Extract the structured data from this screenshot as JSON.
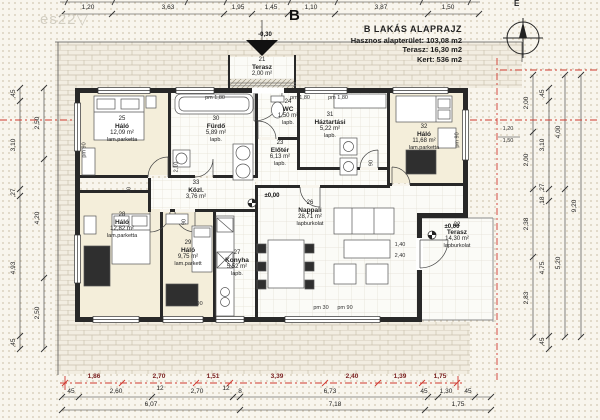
{
  "title_block": {
    "title": "B LAKÁS ALAPRAJZ",
    "line1": "Hasznos alapterület: 103,08 m2",
    "line2": "Terasz: 16,30 m2",
    "line3": "Kert: 536 m2"
  },
  "watermark": "es22▽",
  "section_marker": "B",
  "north_label": "É",
  "rooms": {
    "r21": {
      "num": "21",
      "name": "Terasz",
      "area": "2,00 m²",
      "floor": "lapburkolat"
    },
    "r22": {
      "num": "22",
      "name": "Terasz",
      "area": "14,30 m²",
      "floor": "lapburkolat"
    },
    "r23": {
      "num": "23",
      "name": "Előtér",
      "area": "6,13 m²",
      "floor": "lapb."
    },
    "r24": {
      "num": "24",
      "name": "WC",
      "area": "1,50 m²",
      "floor": "lapb."
    },
    "r25": {
      "num": "25",
      "name": "Háló",
      "area": "12,09 m²",
      "floor": "lam.parketta"
    },
    "r26": {
      "num": "26",
      "name": "Nappali",
      "area": "28,71 m²",
      "floor": "lapburkolat"
    },
    "r27": {
      "num": "27",
      "name": "Konyha",
      "area": "5,52 m²",
      "floor": "lapb."
    },
    "r28": {
      "num": "28",
      "name": "Háló",
      "area": "12,82 m²",
      "floor": "lam.parketta"
    },
    "r29": {
      "num": "29",
      "name": "Háló",
      "area": "9,75 m²",
      "floor": "lam.parkett"
    },
    "r30": {
      "num": "30",
      "name": "Fürdő",
      "area": "5,89 m²",
      "floor": "lapb."
    },
    "r31": {
      "num": "31",
      "name": "Háztartási",
      "area": "5,22 m²",
      "floor": "lapb."
    },
    "r32": {
      "num": "32",
      "name": "Háló",
      "area": "11,68 m²",
      "floor": "lam.parketta"
    },
    "r33": {
      "num": "33",
      "name": "Közl.",
      "area": "3,76 m²",
      "floor": "lapb."
    }
  },
  "levels": {
    "zero": "±0,00",
    "minus": "-0,30"
  },
  "dims": {
    "top": [
      "1,20",
      "3,63",
      "1,95",
      "1,45",
      "1,10",
      "3,87",
      "1,50"
    ],
    "bottom_red": [
      "1,86",
      "2,70",
      "1,51",
      "3,39",
      "2,40",
      "1,39",
      "1,75"
    ],
    "bottom_mid": [
      "45",
      "2,60",
      "12",
      "2,70",
      "12",
      "8",
      "6,73",
      "45",
      "1,30",
      "45"
    ],
    "bottom_total": [
      "6,07",
      "7,18",
      "1,75"
    ],
    "left_inner": [
      ",45",
      "3,10",
      ",27",
      "4,93",
      ",45"
    ],
    "left_outer": [
      "2,50",
      "4,20",
      "2,50"
    ],
    "right_a": [
      "2,00",
      "2,00",
      "2,38",
      "2,83"
    ],
    "right_b": [
      ",45",
      "3,10",
      ",27",
      ",18",
      "4,75",
      ",45"
    ],
    "right_c": [
      "4,00",
      "5,20"
    ],
    "right_total": "9,20"
  },
  "ann": {
    "pm180": "pm 1,80",
    "pm90": "pm 90",
    "pm30": "pm 30",
    "w90": "90",
    "d210": "2,10",
    "d120": "1,20",
    "d150": "1,50",
    "d140": "1,40",
    "d240": "2,40"
  },
  "colors": {
    "red_line": "#cf3a30",
    "wall": "#282828",
    "parquet": "#f4eeda"
  }
}
